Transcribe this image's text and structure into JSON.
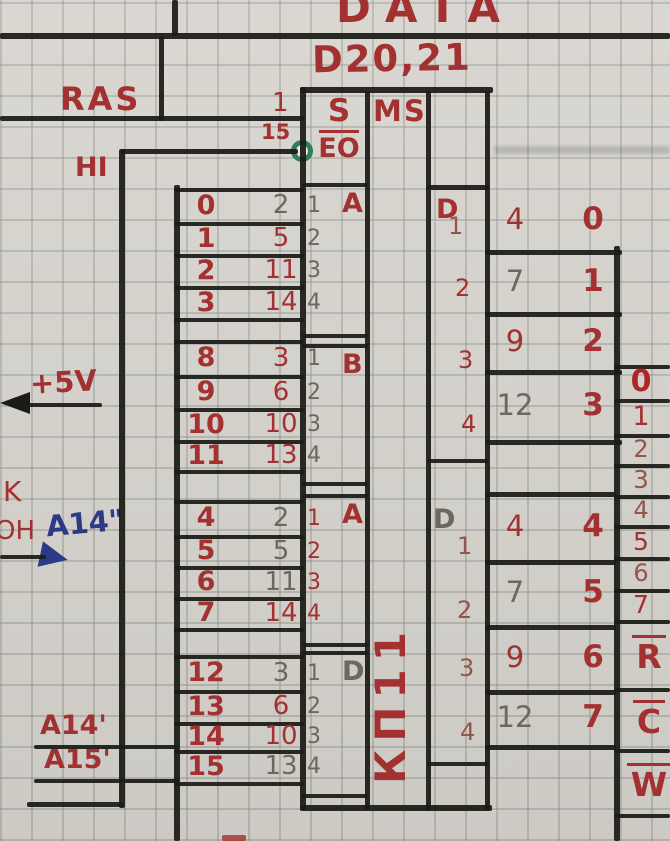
{
  "colors": {
    "paper": "#d8d5cf",
    "grid_line": "#8a928a",
    "wire_black": "#1b1b17",
    "ink_red": "#a33131",
    "pencil_gray": "#6f675e",
    "faded_red": "#95564a",
    "blue_ink": "#2c3a86",
    "bubble_green": "#2e7d5b"
  },
  "header": {
    "bus_title": "DATA",
    "chip_ref": "D20,21"
  },
  "chip": {
    "pin_top": "1",
    "pin_bottom": "15",
    "select_label": "S",
    "enable_label": "EO",
    "type_label": "MS",
    "name": "КП11"
  },
  "left": {
    "ras": "RAS",
    "hi": "HI",
    "supply": "+5V",
    "k": "K",
    "zone": "ОН",
    "zone_note": "A14\"",
    "a14": "A14'",
    "a15": "A15'"
  },
  "input_groups": [
    {
      "label": "A",
      "rows": [
        {
          "signal": "0",
          "pin": "2",
          "num": "1"
        },
        {
          "signal": "1",
          "pin": "5",
          "num": "2"
        },
        {
          "signal": "2",
          "pin": "11",
          "num": "3"
        },
        {
          "signal": "3",
          "pin": "14",
          "num": "4"
        }
      ]
    },
    {
      "label": "B",
      "rows": [
        {
          "signal": "8",
          "pin": "3",
          "num": "1"
        },
        {
          "signal": "9",
          "pin": "6",
          "num": "2"
        },
        {
          "signal": "10",
          "pin": "10",
          "num": "3"
        },
        {
          "signal": "11",
          "pin": "13",
          "num": "4"
        }
      ]
    },
    {
      "label": "A",
      "rows": [
        {
          "signal": "4",
          "pin": "2",
          "num": "1"
        },
        {
          "signal": "5",
          "pin": "5",
          "num": "2"
        },
        {
          "signal": "6",
          "pin": "11",
          "num": "3"
        },
        {
          "signal": "7",
          "pin": "14",
          "num": "4"
        }
      ]
    },
    {
      "label": "D",
      "rows": [
        {
          "signal": "12",
          "pin": "3",
          "num": "1"
        },
        {
          "signal": "13",
          "pin": "6",
          "num": "2"
        },
        {
          "signal": "14",
          "pin": "10",
          "num": "3"
        },
        {
          "signal": "15",
          "pin": "13",
          "num": "4"
        }
      ]
    }
  ],
  "output_groups": [
    {
      "label": "D",
      "rows": [
        {
          "num": "1",
          "pin": "4",
          "signal": "0"
        },
        {
          "num": "2",
          "pin": "7",
          "signal": "1"
        },
        {
          "num": "3",
          "pin": "9",
          "signal": "2"
        },
        {
          "num": "4",
          "pin": "12",
          "signal": "3"
        }
      ]
    },
    {
      "label": "D",
      "rows": [
        {
          "num": "1",
          "pin": "4",
          "signal": "4"
        },
        {
          "num": "2",
          "pin": "7",
          "signal": "5"
        },
        {
          "num": "3",
          "pin": "9",
          "signal": "6"
        },
        {
          "num": "4",
          "pin": "12",
          "signal": "7"
        }
      ]
    }
  ],
  "bus": {
    "numbers": [
      "0",
      "1",
      "2",
      "3",
      "4",
      "5",
      "6",
      "7"
    ],
    "signals": [
      "R",
      "C",
      "W"
    ]
  }
}
